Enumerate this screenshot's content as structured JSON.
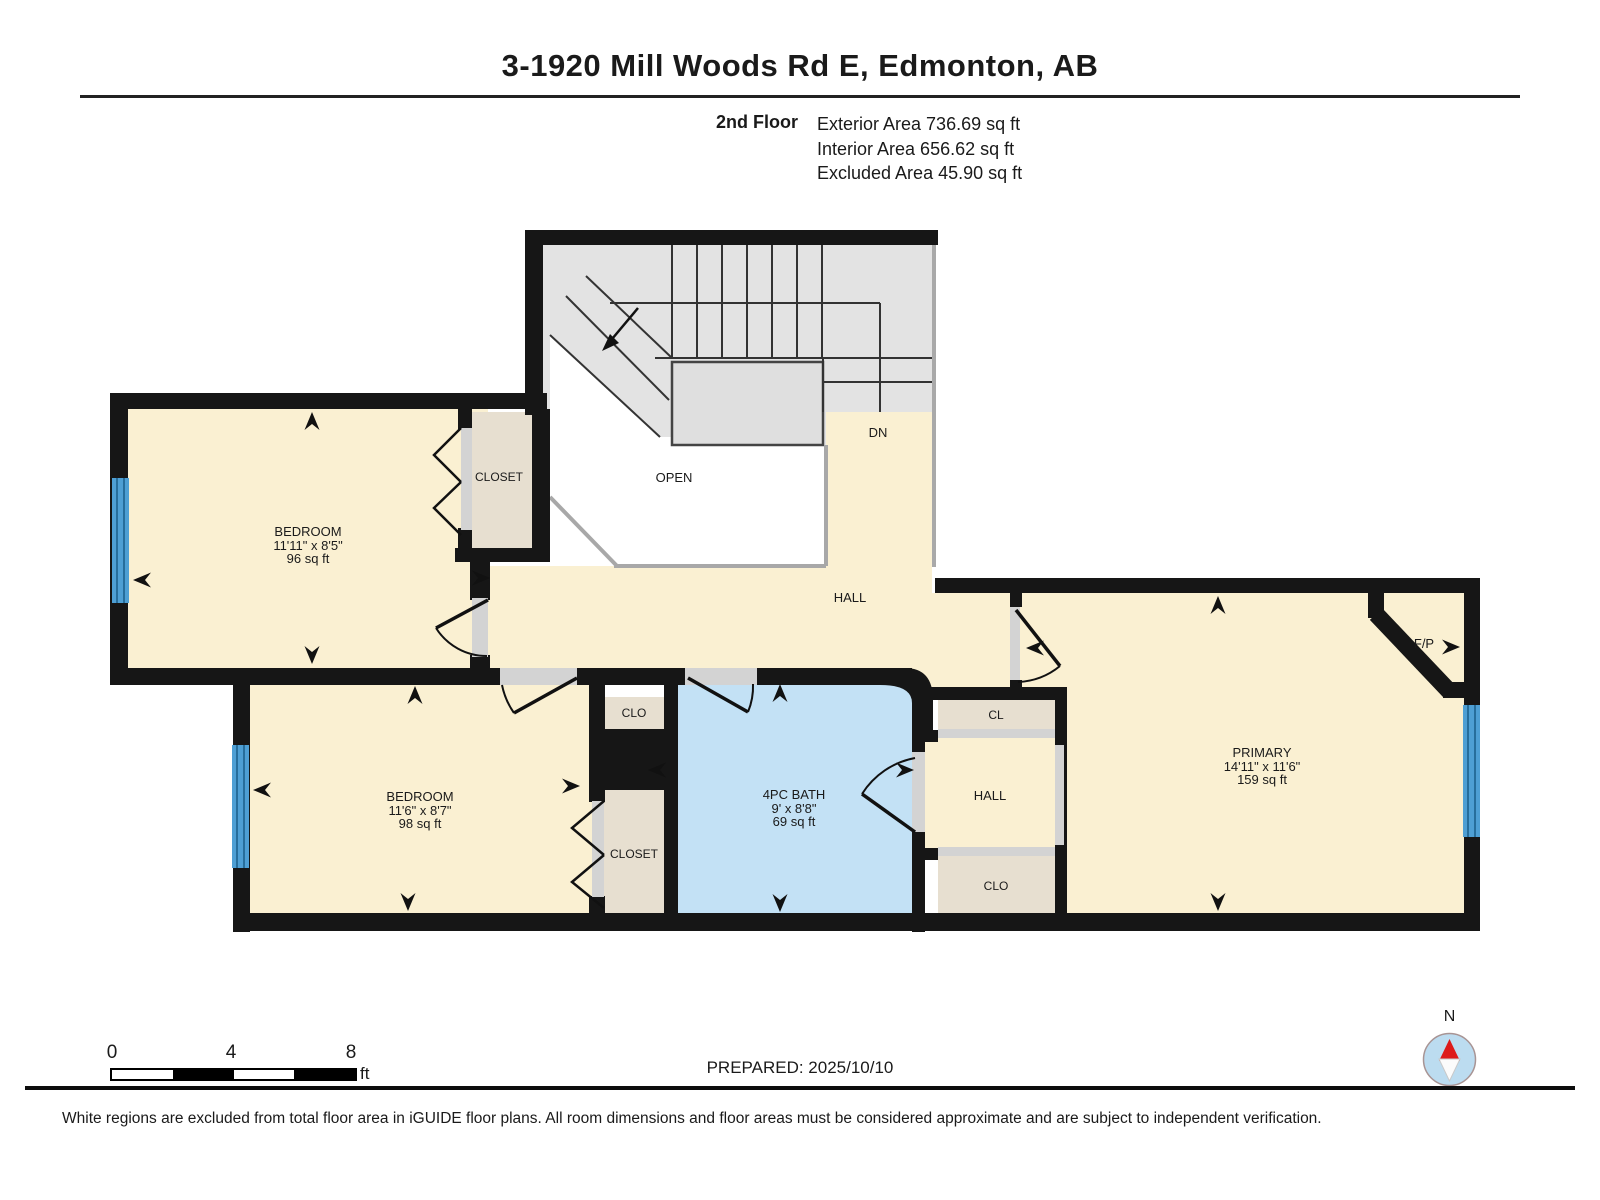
{
  "header": {
    "title": "3-1920 Mill Woods Rd E, Edmonton, AB",
    "floor_label": "2nd Floor",
    "stats": [
      "Exterior Area 736.69 sq ft",
      "Interior Area 656.62 sq ft",
      "Excluded Area 45.90 sq ft"
    ]
  },
  "rooms": {
    "bedroom1": {
      "name": "BEDROOM",
      "dims": "11'11\" x 8'5\"",
      "area": "96 sq ft"
    },
    "bedroom2": {
      "name": "BEDROOM",
      "dims": "11'6\" x 8'7\"",
      "area": "98 sq ft"
    },
    "bath": {
      "name": "4PC BATH",
      "dims": "9' x 8'8\"",
      "area": "69 sq ft"
    },
    "primary": {
      "name": "PRIMARY",
      "dims": "14'11\" x 11'6\"",
      "area": "159 sq ft"
    },
    "closet1": {
      "name": "CLOSET"
    },
    "closet2": {
      "name": "CLOSET"
    },
    "clo_small": {
      "name": "CLO"
    },
    "cl": {
      "name": "CL"
    },
    "hall_right": {
      "name": "HALL"
    },
    "clo_right": {
      "name": "CLO"
    },
    "hall": {
      "name": "HALL"
    },
    "open": {
      "name": "OPEN"
    },
    "dn": {
      "name": "DN"
    },
    "fp": {
      "name": "F/P"
    }
  },
  "scale_bar": {
    "ticks": [
      "0",
      "4",
      "8"
    ],
    "unit": "ft"
  },
  "footer": {
    "prepared": "PREPARED: 2025/10/10",
    "compass_label": "N",
    "disclaimer": "White regions are excluded from total floor area in iGUIDE floor plans. All room dimensions and floor areas must be considered approximate and are subject to independent verification."
  },
  "palette": {
    "wall": "#161616",
    "cream": "#FAF0D2",
    "beige": "#E7DFD0",
    "bath": "#C3E1F5",
    "stair": "#E3E3E3",
    "win": "#4E9FD4",
    "win_line": "#1A5E8A",
    "sill": "#D3D3D3",
    "sill_line": "#A8A8A8",
    "compass_fill": "#BCDCF0",
    "compass_red": "#DD1A1A"
  }
}
